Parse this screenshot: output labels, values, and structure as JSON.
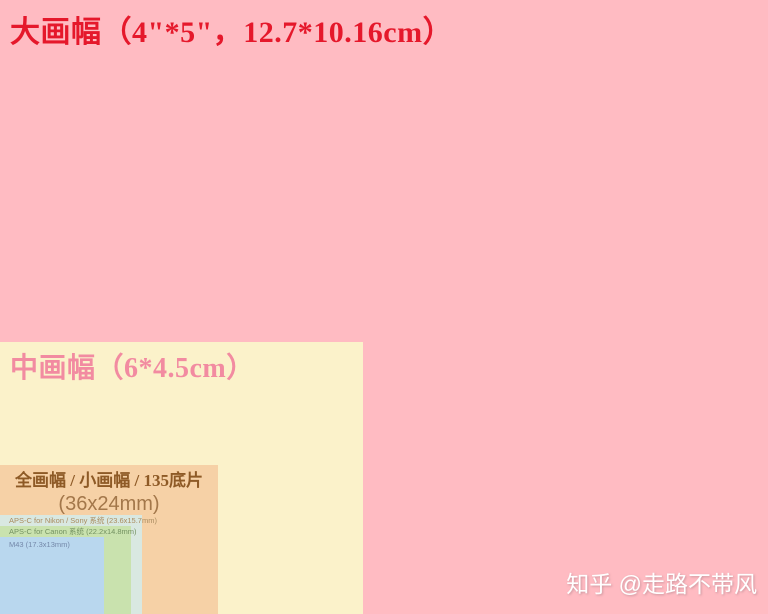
{
  "formats": [
    {
      "id": "large-format",
      "label": "大画幅（4\"*5\"，12.7*10.16cm）",
      "dimensions": "12.7*10.16cm",
      "fill_color": "#ffbbc2",
      "label_color": "#e5182b"
    },
    {
      "id": "medium-format",
      "label": "中画幅（6*4.5cm）",
      "dimensions": "6*4.5cm",
      "fill_color": "#fbf2ca",
      "label_color": "#f28ba1"
    },
    {
      "id": "full-frame",
      "label": "全画幅 / 小画幅 / 135底片",
      "sublabel": "(36x24mm)",
      "dimensions": "36x24mm",
      "fill_color": "#f6d1a6",
      "label_color": "#8e5a26"
    },
    {
      "id": "apsc-nikon-sony",
      "label": "APS-C for Nikon / Sony 系统 (23.6x15.7mm)",
      "dimensions": "23.6x15.7mm",
      "fill_color": "#d9e8e1",
      "label_color": "#a98c60"
    },
    {
      "id": "apsc-canon",
      "label": "APS-C for Canon 系统 (22.2x14.8mm)",
      "dimensions": "22.2x14.8mm",
      "fill_color": "#c9e2ae",
      "label_color": "#739161"
    },
    {
      "id": "m43",
      "label": "M43 (17.3x13mm)",
      "dimensions": "17.3x13mm",
      "fill_color": "#b9d7ee",
      "label_color": "#7488a9"
    }
  ],
  "watermark": {
    "text": "知乎 @走路不带风"
  }
}
